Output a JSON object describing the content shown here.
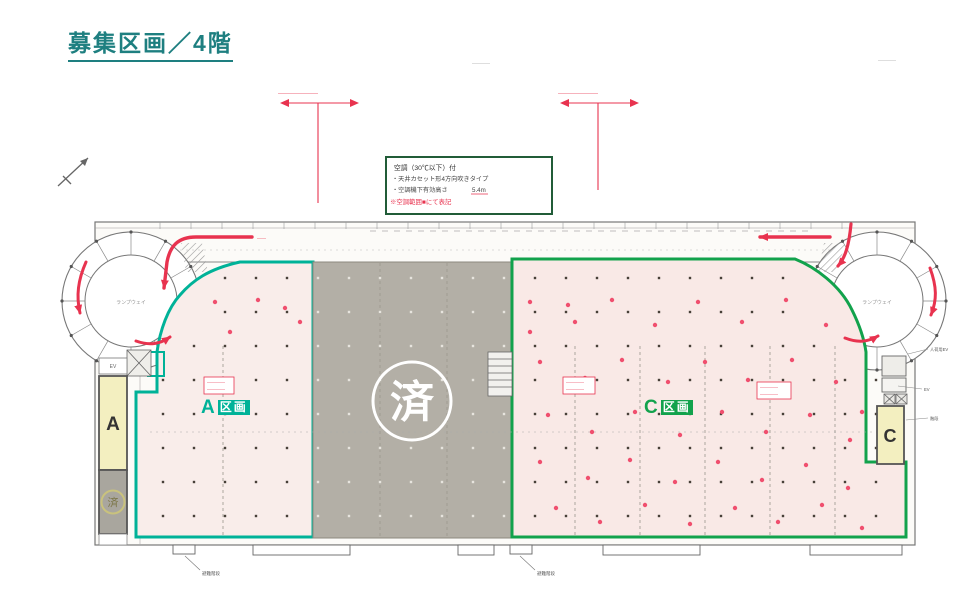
{
  "page": {
    "title": "募集区画／4階"
  },
  "colors": {
    "title_teal": "#1e7f80",
    "section_a_boundary": "#00b298",
    "section_c_boundary": "#12a24c",
    "taken_section_gray": "#b3afa6",
    "floor_pink": "#f9ebe8",
    "annotation_red": "#e8334f",
    "dock_yellow": "#f3efc0"
  },
  "legend": {
    "line1": "空調（30℃以下）付",
    "line2": "・天井カセット形4方向吹きタイプ",
    "line3a": "・空調機下有効高さ",
    "line3b": "5.4m",
    "line4": "※空調範囲■にて表記"
  },
  "sections": {
    "a": {
      "prefix": "A",
      "suffix": "区画",
      "dock_label": "A"
    },
    "center": {
      "status": "済"
    },
    "c": {
      "prefix": "C",
      "suffix": "区画",
      "dock_label": "C"
    },
    "a_dock_status": "済"
  },
  "ramps": {
    "left": "ランプウェイ",
    "right": "ランプウェイ"
  },
  "notes": {
    "dim_left": "――――――――",
    "dim_right": "――――――――",
    "top_note": "――――",
    "red_box": "――――",
    "arrow_note": "――",
    "callout_bottom": "避難階段",
    "callout_right_1": "人荷用EV",
    "callout_right_2": "EV",
    "callout_right_3": "階段",
    "dock_top_label": "EV"
  },
  "plan": {
    "grid": {
      "x0": 163,
      "x1": 898,
      "dx": 31,
      "y0": 278,
      "y1": 516,
      "dy": 34
    },
    "gray_zone": {
      "x0": 313,
      "x1": 512
    },
    "ramp_left": {
      "cx": 131,
      "cy": 301,
      "r": 72
    },
    "ramp_right": {
      "cx": 877,
      "cy": 301,
      "r": 72
    },
    "taken_circle": {
      "cx": 412,
      "cy": 401,
      "r": 38
    },
    "ac_dots": [
      [
        215,
        302
      ],
      [
        258,
        300
      ],
      [
        300,
        322
      ],
      [
        230,
        332
      ],
      [
        285,
        308
      ],
      [
        530,
        302
      ],
      [
        575,
        322
      ],
      [
        612,
        300
      ],
      [
        655,
        325
      ],
      [
        698,
        302
      ],
      [
        742,
        322
      ],
      [
        786,
        300
      ],
      [
        826,
        325
      ],
      [
        530,
        332
      ],
      [
        568,
        305
      ],
      [
        540,
        362
      ],
      [
        585,
        378
      ],
      [
        622,
        360
      ],
      [
        668,
        382
      ],
      [
        705,
        362
      ],
      [
        748,
        380
      ],
      [
        792,
        360
      ],
      [
        836,
        382
      ],
      [
        862,
        412
      ],
      [
        548,
        415
      ],
      [
        592,
        432
      ],
      [
        635,
        412
      ],
      [
        680,
        435
      ],
      [
        722,
        412
      ],
      [
        766,
        432
      ],
      [
        810,
        415
      ],
      [
        850,
        440
      ],
      [
        540,
        462
      ],
      [
        588,
        478
      ],
      [
        630,
        460
      ],
      [
        675,
        482
      ],
      [
        718,
        462
      ],
      [
        762,
        480
      ],
      [
        806,
        465
      ],
      [
        848,
        488
      ],
      [
        556,
        508
      ],
      [
        600,
        522
      ],
      [
        645,
        505
      ],
      [
        690,
        524
      ],
      [
        735,
        508
      ],
      [
        778,
        522
      ],
      [
        822,
        505
      ],
      [
        862,
        528
      ]
    ]
  }
}
